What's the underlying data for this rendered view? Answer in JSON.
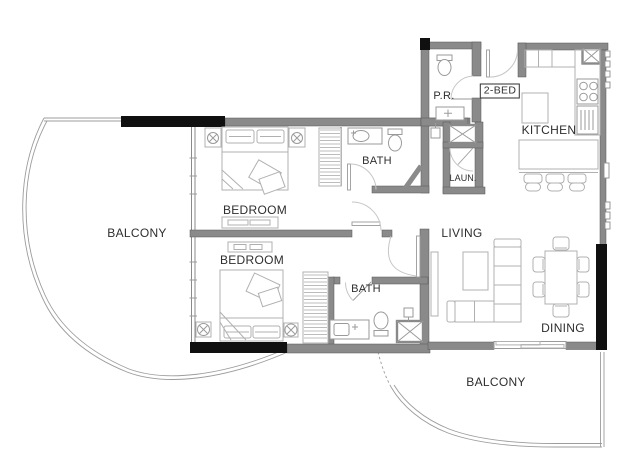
{
  "plan": {
    "unit_type_label": "2-BED",
    "rooms": {
      "balcony_left": "BALCONY",
      "bedroom_top": "BEDROOM",
      "bedroom_bottom": "BEDROOM",
      "bath_top": "BATH",
      "bath_bottom": "BATH",
      "powder_room": "P.R.",
      "laundry": "LAUN.",
      "kitchen": "KITCHEN",
      "living": "LIVING",
      "dining": "DINING",
      "balcony_bottom": "BALCONY"
    },
    "colors": {
      "wall-color": "#8a8a8a",
      "structural-color": "#101010",
      "furniture-color": "#b0b0b0",
      "fixture-color": "#9a9a9a",
      "door-color": "#c6c6c6",
      "railing-color": "#9c9c9c",
      "text-color": "#2e2e2e"
    }
  }
}
